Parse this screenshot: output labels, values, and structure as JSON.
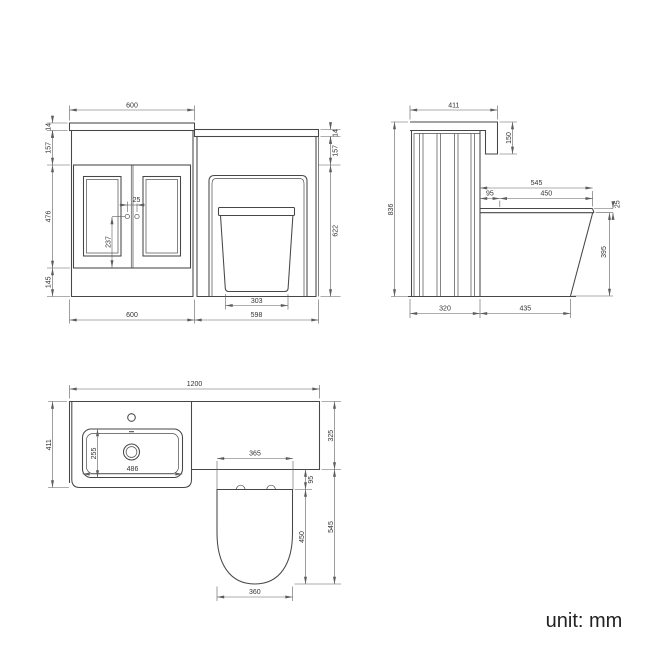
{
  "front_view": {
    "dims": {
      "top_width": "600",
      "worktop_thickness": "14",
      "apron_height": "157",
      "door_height": "476",
      "plinth_height": "145",
      "handle_spacing": "25",
      "handle_drop": "237",
      "wc_worktop_thickness": "14",
      "wc_apron_height": "157",
      "wc_body_height": "622",
      "pan_base_width": "303",
      "vanity_width": "600",
      "wc_width": "598"
    }
  },
  "side_view": {
    "dims": {
      "worktop_depth": "411",
      "end_panel_drop": "150",
      "total_height": "836",
      "seat_projection_total": "545",
      "seat_setback": "95",
      "seat_length": "450",
      "seat_thickness": "25",
      "pan_front_height": "395",
      "unit_depth": "320",
      "pan_projection": "435"
    }
  },
  "plan_view": {
    "dims": {
      "total_width": "1200",
      "vanity_depth": "411",
      "bowl_depth": "255",
      "bowl_width": "486",
      "seat_back_width": "365",
      "wc_top_depth": "325",
      "seat_gap": "95",
      "seat_length": "450",
      "seat_total_projection": "545",
      "seat_front_width": "360"
    }
  },
  "footer": {
    "unit_note": "unit: mm"
  },
  "colors": {
    "object_line": "#474747",
    "dimension_line": "#5d5d5d",
    "text": "#333333",
    "background": "#ffffff"
  }
}
